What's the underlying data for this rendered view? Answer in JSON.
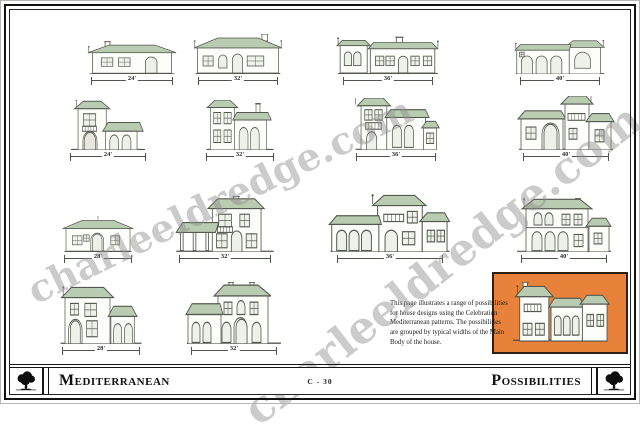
{
  "watermark": {
    "text": "charleeldredge.com"
  },
  "description": "This page illustrates a range of possibilities for house designs using the Celebration Mediterranean patterns. The possibilities are grouped by typical widths of the Main Body of the house.",
  "footer": {
    "left_title": "Mediterranean",
    "center_code": "C - 30",
    "right_title": "Possibilities",
    "left_logo_icon": "oak-tree-logo",
    "right_logo_icon": "oak-tree-logo"
  },
  "colors": {
    "roof": "#b9cbb0",
    "wall": "#fdfdfa",
    "outline": "#54594f",
    "highlight_box": "#e8823b",
    "watermark_gray": "#8d8d8d"
  },
  "houses": [
    {
      "id": "r1c1",
      "width_label": "24'",
      "type": "one-story cottage"
    },
    {
      "id": "r1c2",
      "width_label": "32'",
      "type": "one-story hip roof"
    },
    {
      "id": "r1c3",
      "width_label": "36'",
      "type": "one-story long body"
    },
    {
      "id": "r1c4",
      "width_label": "40'",
      "type": "one-story with arcade"
    },
    {
      "id": "r2c1",
      "width_label": "24'",
      "type": "two-story tower with porch"
    },
    {
      "id": "r2c2",
      "width_label": "32'",
      "type": "two-story with wing"
    },
    {
      "id": "r2c3",
      "width_label": "36'",
      "type": "two-story tower with wing"
    },
    {
      "id": "r2c4",
      "width_label": "40'",
      "type": "two-story center tower"
    },
    {
      "id": "r3c1",
      "width_label": "28'",
      "type": "one-story hip roof"
    },
    {
      "id": "r3c2",
      "width_label": "32'",
      "type": "two-story with side porch"
    },
    {
      "id": "r3c3",
      "width_label": "36'",
      "type": "two-story with arcade"
    },
    {
      "id": "r3c4",
      "width_label": "40'",
      "type": "two-story with wings"
    },
    {
      "id": "r4c1",
      "width_label": "28'",
      "type": "two-story with garage wing"
    },
    {
      "id": "r4c2",
      "width_label": "32'",
      "type": "two-story with porch"
    }
  ],
  "highlight": {
    "type": "two-story tower example (highlighted)"
  }
}
